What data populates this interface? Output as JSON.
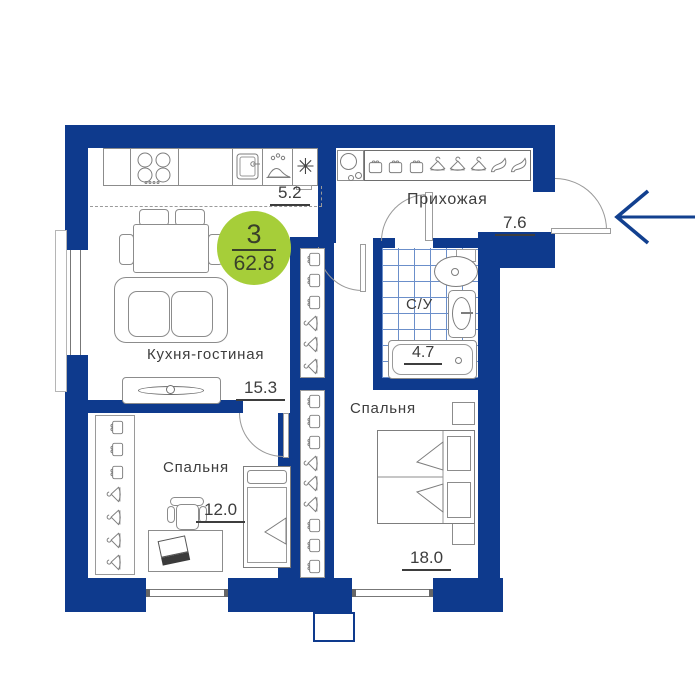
{
  "badge": {
    "rooms": "3",
    "area": "62.8",
    "color": "#a6ce39"
  },
  "rooms": {
    "kitchen_living": {
      "name": "Кухня-гостиная",
      "area": "15.3",
      "kitchen_zone_area": "5.2"
    },
    "hallway": {
      "name": "Прихожая",
      "area": "7.6"
    },
    "bathroom": {
      "name": "С/У",
      "area": "4.7"
    },
    "bedroom_small": {
      "name": "Спальня",
      "area": "12.0"
    },
    "bedroom_large": {
      "name": "Спальня",
      "area": "18.0"
    }
  },
  "icons": {
    "snowflake_glyph": "✳",
    "kitchen_appliances": [
      "stove-burners",
      "sink",
      "dish-rack",
      "fridge-snowflake"
    ],
    "hallway_shelf": [
      "bag",
      "bag",
      "bag",
      "hanger",
      "hanger",
      "hanger",
      "heel-shoe",
      "heel-shoe"
    ],
    "hallway_left": [
      "washing-machine"
    ],
    "closet_top": [
      "bag",
      "bag",
      "bag",
      "hanger",
      "hanger",
      "hanger"
    ],
    "closet_bottom": [
      "bag",
      "bag",
      "bag",
      "hanger",
      "hanger",
      "hanger",
      "bag",
      "bag",
      "bag"
    ],
    "wardrobe_bedroom_small": [
      "bag",
      "bag",
      "bag",
      "hanger",
      "hanger",
      "hanger",
      "hanger"
    ],
    "bathroom_fixtures": [
      "mirror-shelf",
      "wash-basin",
      "toilet",
      "bathtub"
    ],
    "entrance": "entrance-arrow-left"
  },
  "colors": {
    "wall": "#0e3a8d",
    "tile_line": "#6b8fca",
    "badge_green": "#a6ce39",
    "text": "#3d3d3d"
  }
}
